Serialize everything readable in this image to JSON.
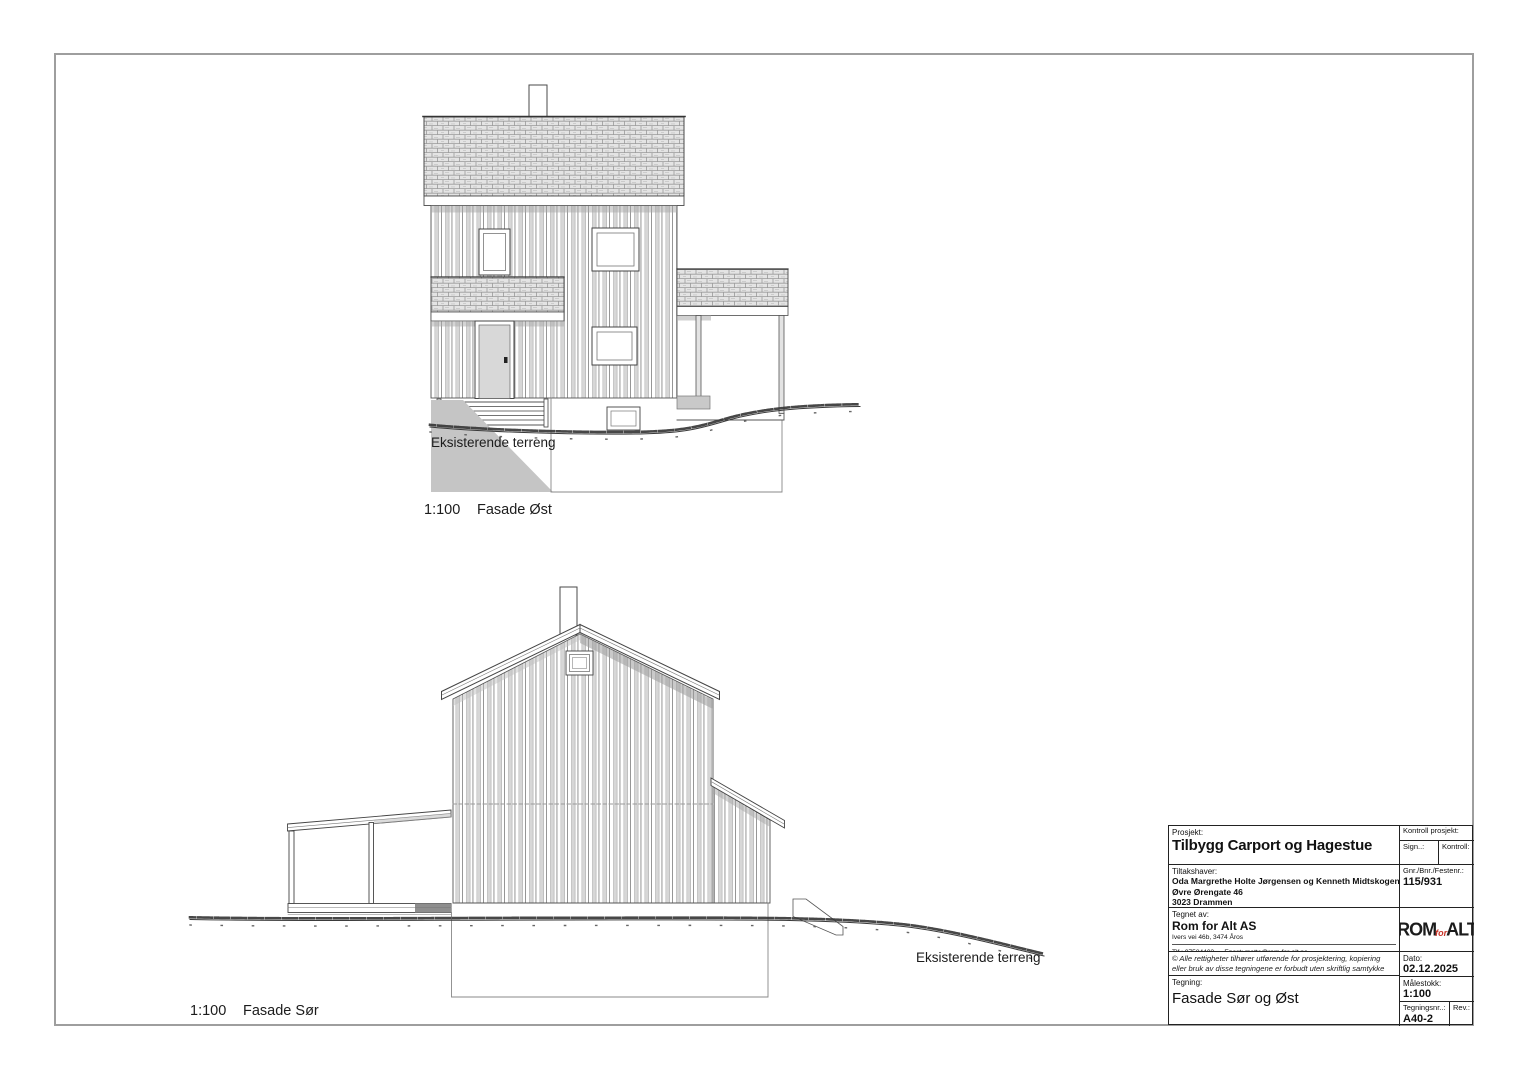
{
  "page": {
    "background": "#ffffff",
    "frame_color": "#9e9e9e",
    "line_color": "#3c3c3c",
    "shade_color": "#c5c5c5",
    "logo_accent": "#c8352a"
  },
  "drawings": [
    {
      "scale": "1:100",
      "name": "Fasade Øst",
      "terrain_label": "Eksisterende terreng"
    },
    {
      "scale": "1:100",
      "name": "Fasade Sør",
      "terrain_label": "Eksisterende terreng"
    }
  ],
  "title_block": {
    "prosjekt_label": "Prosjekt:",
    "prosjekt": "Tilbygg Carport og Hagestue",
    "kontroll_prosjekt_label": "Kontroll prosjekt:",
    "sign_label": "Sign..:",
    "kontroll_label": "Kontroll:",
    "tiltakshaver_label": "Tiltakshaver:",
    "tiltakshaver_name": "Oda Margrethe Holte Jørgensen og Kenneth Midtskogen",
    "tiltakshaver_street": "Øvre Ørengate 46",
    "tiltakshaver_city": "3023 Drammen",
    "gnr_label": "Gnr./Bnr./Festenr.:",
    "gnr": "115/931",
    "tegnet_av_label": "Tegnet av:",
    "tegnet_av": "Rom for Alt AS",
    "tegnet_av_adresse": "Ivers vei 46b, 3474 Åros",
    "tlf": "Tlf.: 97584403",
    "epost": "Epost: mette@rom-for-alt.no",
    "logo_rom": "ROM",
    "logo_for": "for",
    "logo_alt": "ALT",
    "copyright": "© Alle rettigheter tilhører utførende for prosjektering, kopiering eller bruk av disse tegningene er forbudt uten skriftlig samtykke",
    "dato_label": "Dato:",
    "dato": "02.12.2025",
    "tegning_label": "Tegning:",
    "tegning": "Fasade Sør og Øst",
    "malestokk_label": "Målestokk:",
    "malestokk": "1:100",
    "tegningsnr_label": "Tegningsnr..:",
    "tegningsnr": "A40-2",
    "rev_label": "Rev.:"
  }
}
